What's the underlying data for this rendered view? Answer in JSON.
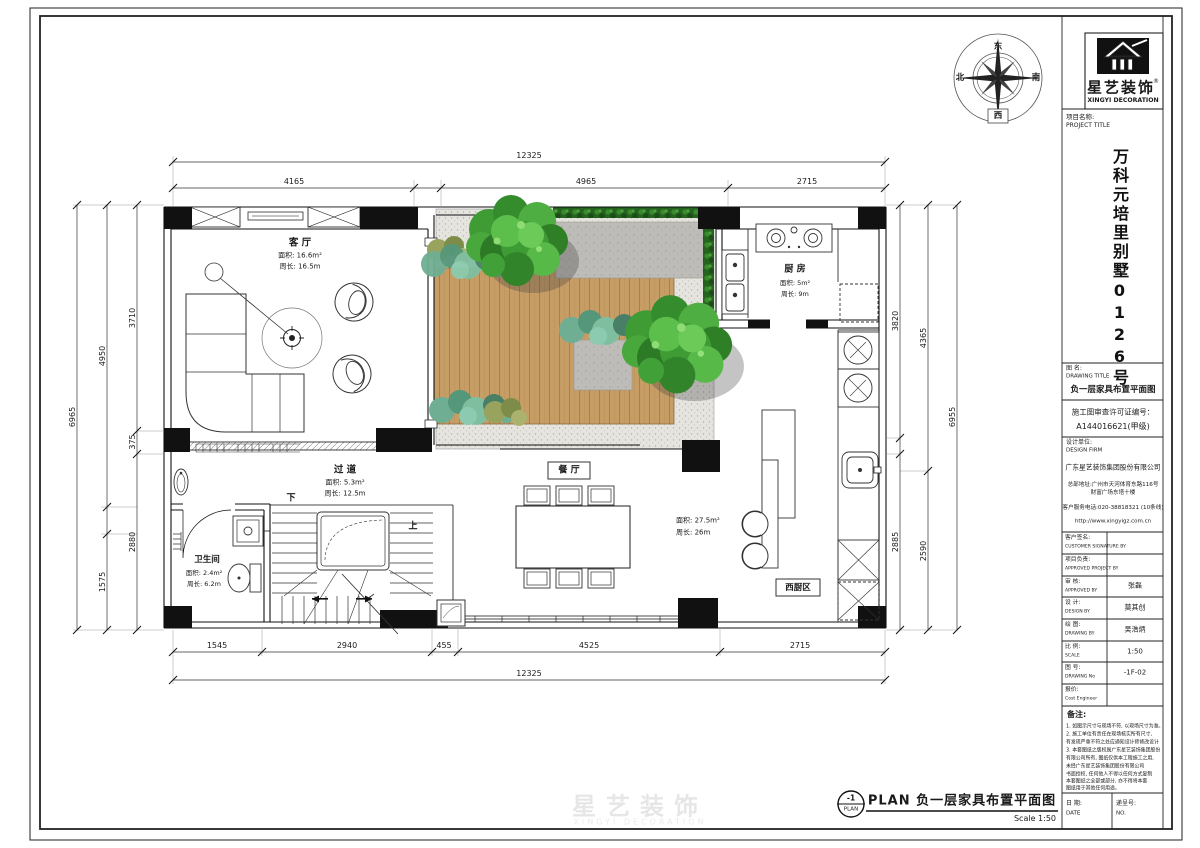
{
  "colors": {
    "line": "#1a1a1a",
    "wood_deck": "#c79d66",
    "gravel": "#e6e4de",
    "hedge_green": "#25641f",
    "tree_green": "#3f9c35",
    "pad_gray": "#bdbcb8",
    "column_black": "#111111"
  },
  "compass": {
    "east": "东",
    "south": "南",
    "west": "西",
    "north": "北"
  },
  "title_block": {
    "logo": {
      "brand": "星艺装饰",
      "reg": "®",
      "brand_en": "XINGYI DECORATION"
    },
    "project_label": "项目名称:",
    "project_label_en": "PROJECT TITLE",
    "project_name": "万科元培里别墅0126号",
    "drawing_title_label": "图 名:",
    "drawing_title_label_en": "DRAWING TITLE",
    "drawing_title": "负一层家具布置平面图",
    "permit_label": "施工图审查许可证编号：",
    "permit_no": "A144016621(甲级)",
    "design_firm_label": "设计单位:",
    "design_firm_label_en": "DESIGN FIRM",
    "design_firm": "广东星艺装饰集团股份有限公司",
    "firm_address": "总部地址:广州市天河体育东路116号",
    "firm_address2": "财富广场东塔十楼",
    "service_phone": "客户服务电话:020-38818321 (10条线)",
    "website": "http://www.xingyigz.com.cn",
    "rows": [
      {
        "label": "客户签名:",
        "label_en": "CUSTOMER SIGNATURE BY",
        "value": ""
      },
      {
        "label": "项目负责:",
        "label_en": "APPROVED PROJECT BY",
        "value": ""
      },
      {
        "label": "审 核:",
        "label_en": "APPROVED BY",
        "value": "张磊"
      },
      {
        "label": "设 计:",
        "label_en": "DESIGN BY",
        "value": "莫其创"
      },
      {
        "label": "绘 图:",
        "label_en": "DRAWING BY",
        "value": "吴浩炳"
      },
      {
        "label": "比 例:",
        "label_en": "SCALE",
        "value": "1:50"
      },
      {
        "label": "图 号:",
        "label_en": "DRAWING No",
        "value": "-1F-02"
      },
      {
        "label": "报价:",
        "label_en": "Cost Engineer",
        "value": ""
      }
    ],
    "notes_title": "备注:",
    "notes": [
      "1. 如图示尺寸与现场不符, 以现场尺寸为准。",
      "2. 施工单位有责任在现场核实所有尺寸,",
      "有发现严重不符之处应通知设计师修改设计",
      "3. 本套图纸之版权属广东星艺装饰集团股份",
      "有限公司所有, 图纸仅供本工程施工之用,",
      "未经广东星艺装饰集团股份有限公司",
      "书面授权, 任何他人不得以任何方式复制",
      "本套图纸之全部或部分, 亦不得将本套",
      "图纸用于其他任何用途。"
    ],
    "date_label": "日 期:",
    "date_label_en": "DATE",
    "no_label": "递呈号:",
    "no_label_en": "NO."
  },
  "rooms": {
    "living": {
      "name": "客 厅",
      "area": "面积: 16.6m²",
      "perimeter": "周长: 16.5m"
    },
    "kitchen": {
      "name": "厨 房",
      "area": "面积: 5m²",
      "perimeter": "周长: 9m"
    },
    "hallway": {
      "name": "过 道",
      "area": "面积: 5.3m²",
      "perimeter": "周长: 12.5m"
    },
    "bathroom": {
      "name": "卫生间",
      "area": "面积: 2.4m²",
      "perimeter": "周长: 6.2m"
    },
    "dining": {
      "name": "餐 厅",
      "area": "面积: 27.5m²",
      "perimeter": "周长: 26m"
    },
    "west_kitchen": {
      "name": "西厨区"
    }
  },
  "stairs": {
    "up": "上",
    "down": "下"
  },
  "dims": {
    "top_total": "12325",
    "top": [
      "4165",
      "4965",
      "2715"
    ],
    "bottom": [
      "1545",
      "2940",
      "455",
      "4525",
      "2715"
    ],
    "bottom_total": "12325",
    "left_inner": [
      "3710",
      "375",
      "2880"
    ],
    "left_mid": [
      "4950",
      "1575"
    ],
    "left_total": "6965",
    "right_inner": [
      "3820",
      "2885"
    ],
    "right_mid": [
      "4365",
      "2590"
    ],
    "right_total": "6955"
  },
  "footer": {
    "tag": "-1",
    "tag_sub": "PLAN",
    "title": "PLAN 负一层家具布置平面图",
    "scale": "Scale 1:50"
  },
  "watermark": {
    "text": "星艺装饰",
    "sub": "XINGYI DECORATION"
  }
}
